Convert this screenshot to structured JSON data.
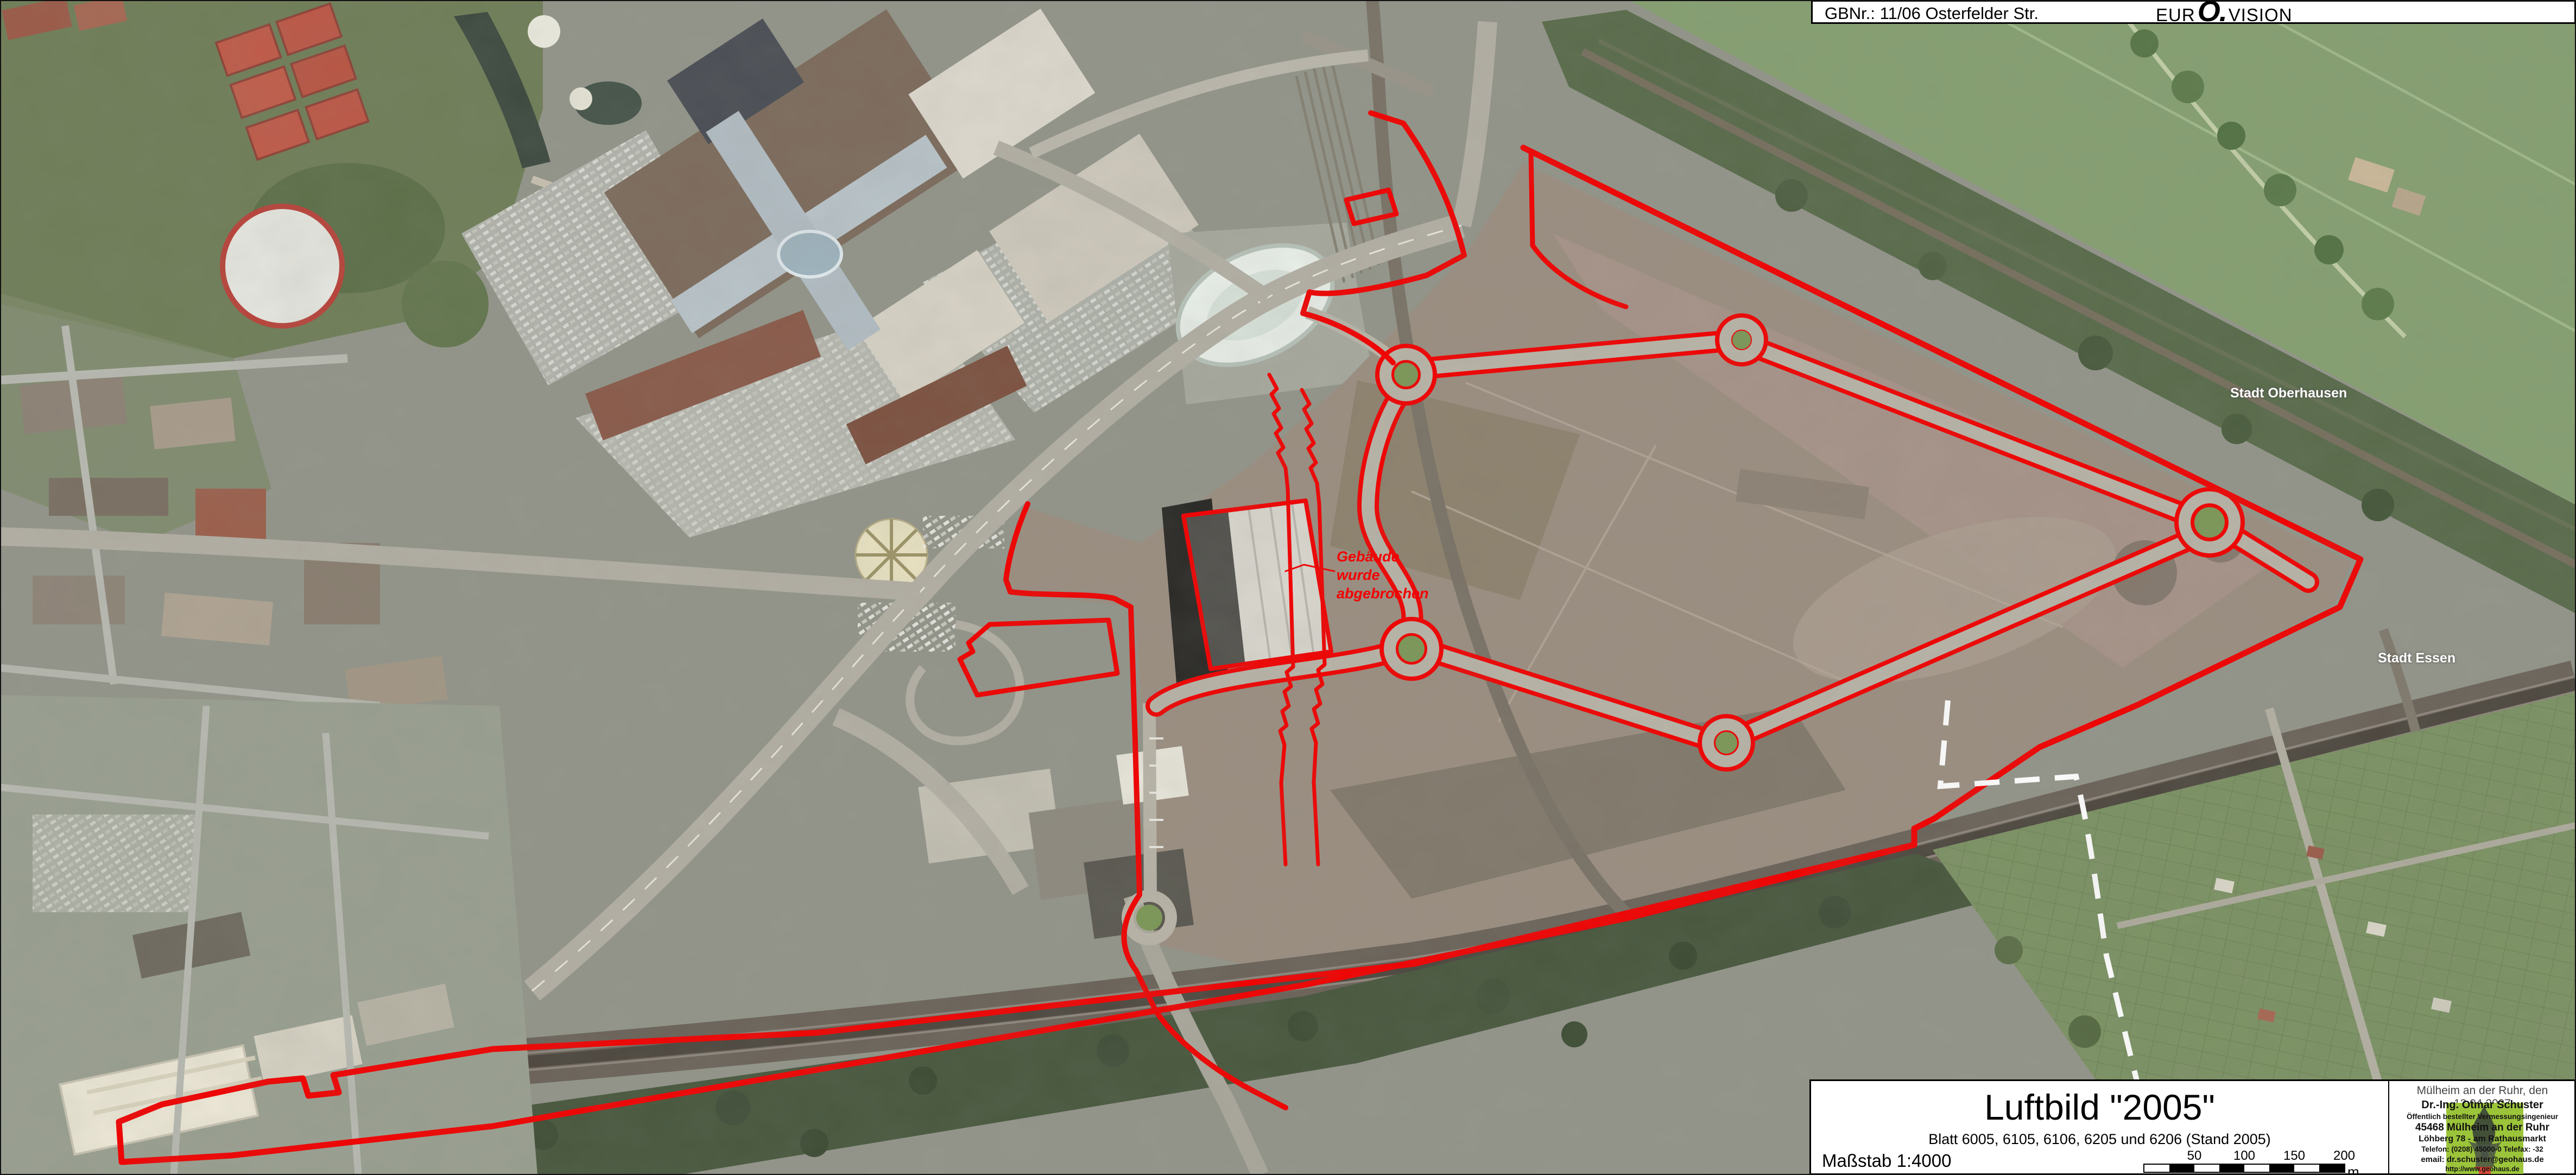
{
  "header": {
    "gbnr": "GBNr.: 11/06 Osterfelder Str.",
    "logo": {
      "part1": "EUR",
      "part2": "O.",
      "part3": "VISION"
    }
  },
  "map": {
    "labels": {
      "city_north": "Stadt Oberhausen",
      "city_south": "Stadt Essen",
      "annotation": "Gebäude\nwurde\nabgebrochen"
    },
    "colors": {
      "boundary_red": "#f20000",
      "city_boundary_white": "#ffffff",
      "roundabout_green": "#7c9757"
    }
  },
  "title_block": {
    "title": "Luftbild \"2005\"",
    "subtitle": "Blatt 6005, 6105, 6106, 6205 und 6206 (Stand 2005)",
    "scale_label": "Maßstab 1:4000",
    "scale_bar": {
      "labels": [
        "50",
        "100",
        "150",
        "200"
      ],
      "unit": "m"
    },
    "date_line": "Mülheim an der Ruhr, den 12.04.2007",
    "surveyor": {
      "name": "Dr.-Ing. Otmar Schuster",
      "title": "Öffentlich bestellter Vermessungsingenieur",
      "address1": "45468 Mülheim an der Ruhr",
      "address2": "Löhberg 78 - am Rathausmarkt",
      "phone": "Telefon: (0208) 45000-0  Telefax: -32",
      "email": "email: dr.schuster@geohaus.de",
      "web": "http://www.geohaus.de"
    }
  }
}
